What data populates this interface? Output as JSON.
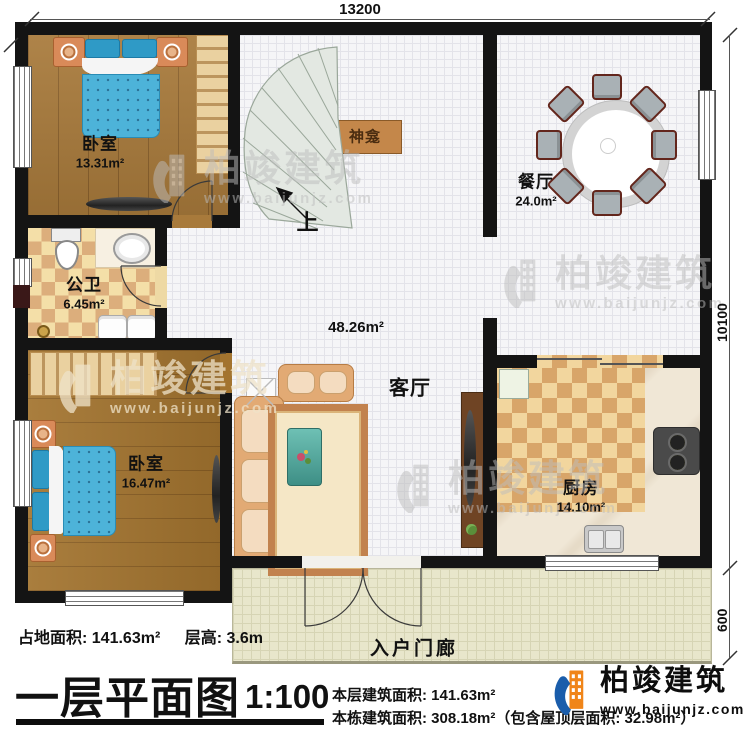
{
  "dimensions": {
    "width_top": "13200",
    "height_main": "10100",
    "height_porch": "600"
  },
  "rooms": {
    "bedroom1": {
      "label": "卧室",
      "area": "13.31m²"
    },
    "bathroom": {
      "label": "公卫",
      "area": "6.45m²"
    },
    "bedroom2": {
      "label": "卧室",
      "area": "16.47m²"
    },
    "dining": {
      "label": "餐厅",
      "area": "24.0m²"
    },
    "living": {
      "label": "客厅",
      "area": "48.26m²"
    },
    "kitchen": {
      "label": "厨房",
      "area": "14.10m²"
    },
    "porch": {
      "label": "入户门廊"
    },
    "shrine": {
      "label": "神龛"
    },
    "stairs_up": "上"
  },
  "footer": {
    "site_area": "占地面积: 141.63m²",
    "floor_height": "层高: 3.6m",
    "title": "一层平面图",
    "scale": "1:100",
    "floor_area": "本层建筑面积: 141.63m²",
    "total_area": "本栋建筑面积: 308.18m²（包含屋顶层面积: 32.98m²）"
  },
  "brand": {
    "name": "柏竣建筑",
    "website": "www.baijunjz.com"
  },
  "watermark": {
    "name": "柏竣建筑",
    "website": "www.baijunjz.com"
  },
  "colors": {
    "wall": "#141414",
    "accent_blue": "#1a5dab",
    "accent_orange": "#f08519"
  }
}
